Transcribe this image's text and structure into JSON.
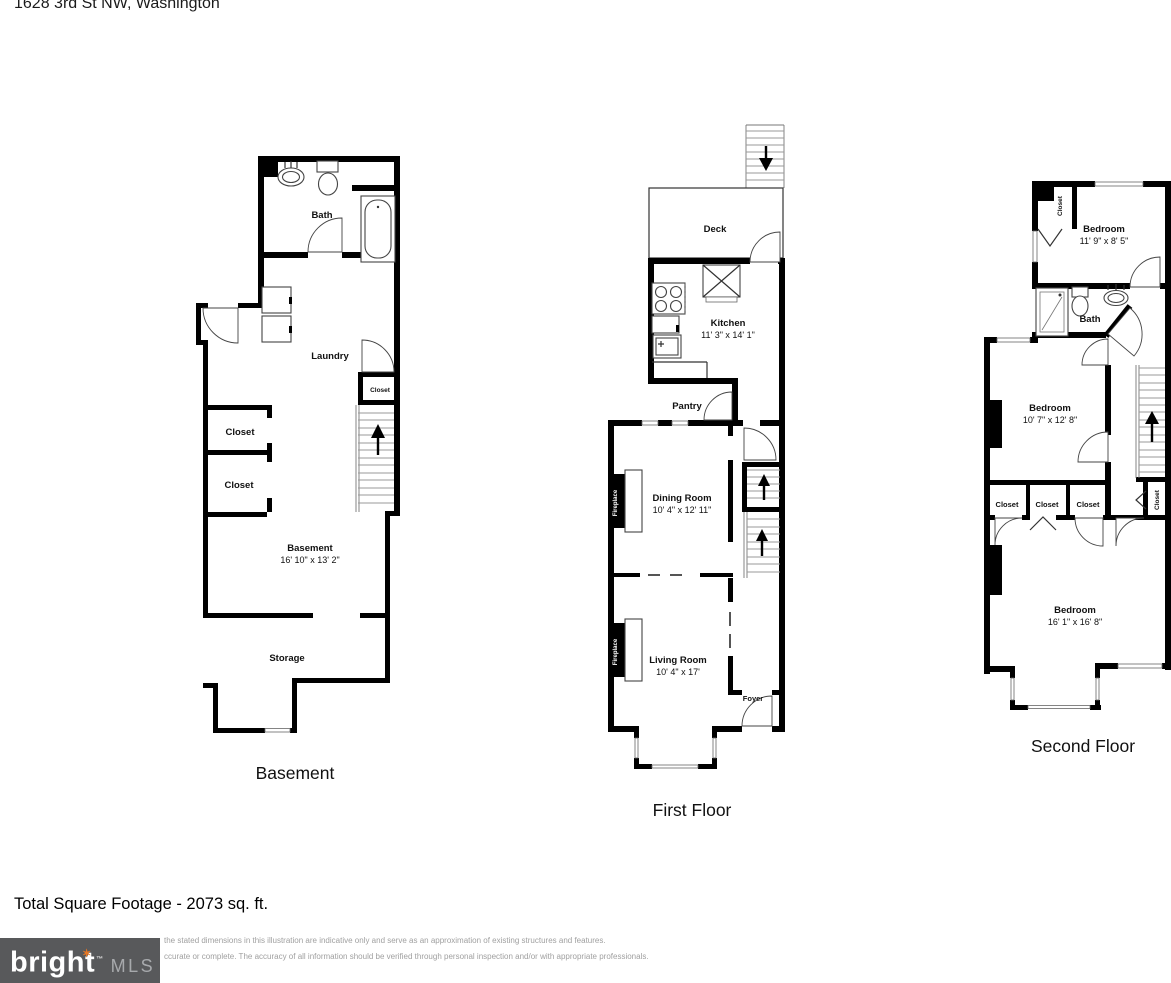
{
  "header": {
    "address": "1628 3rd St NW, Washington"
  },
  "floors": {
    "basement": {
      "title": "Basement",
      "bath": "Bath",
      "laundry": "Laundry",
      "stair_closet": "Closet",
      "closet_upper": "Closet",
      "closet_lower": "Closet",
      "room": "Basement",
      "room_dims": "16' 10\" x 13' 2\"",
      "storage": "Storage"
    },
    "first": {
      "title": "First Floor",
      "deck": "Deck",
      "kitchen": "Kitchen",
      "kitchen_dims": "11' 3\" x 14' 1\"",
      "pantry": "Pantry",
      "dining": "Dining Room",
      "dining_dims": "10' 4\" x 12' 11\"",
      "fireplace": "Fireplace",
      "living": "Living Room",
      "living_dims": "10' 4\" x 17'",
      "foyer": "Foyer"
    },
    "second": {
      "title": "Second Floor",
      "closet_top": "Closet",
      "bedroom_top": "Bedroom",
      "bedroom_top_dims": "11' 9\" x 8' 5\"",
      "bath": "Bath",
      "bedroom_mid": "Bedroom",
      "bedroom_mid_dims": "10' 7\" x 12' 8\"",
      "closet_1": "Closet",
      "closet_2": "Closet",
      "closet_3": "Closet",
      "closet_hall": "Closet",
      "bedroom_low": "Bedroom",
      "bedroom_low_dims": "16' 1\" x 16' 8\""
    }
  },
  "footer": {
    "total": "Total Square Footage - 2073 sq. ft.",
    "disclaimer1": "the stated dimensions in this illustration are indicative only and serve as an approximation of existing structures and features.",
    "disclaimer2": "ccurate or complete. The accuracy of all information should be verified through personal inspection and/or with appropriate professionals.",
    "logo": {
      "bright": "bright",
      "mls": "MLS",
      "tm": "™"
    }
  },
  "colors": {
    "wall": "#000000",
    "logo_background": "#58595b",
    "logo_star": "#e87722",
    "logo_mls_text": "#a7a9ac",
    "disclaimer_text": "#a0a0a0"
  }
}
